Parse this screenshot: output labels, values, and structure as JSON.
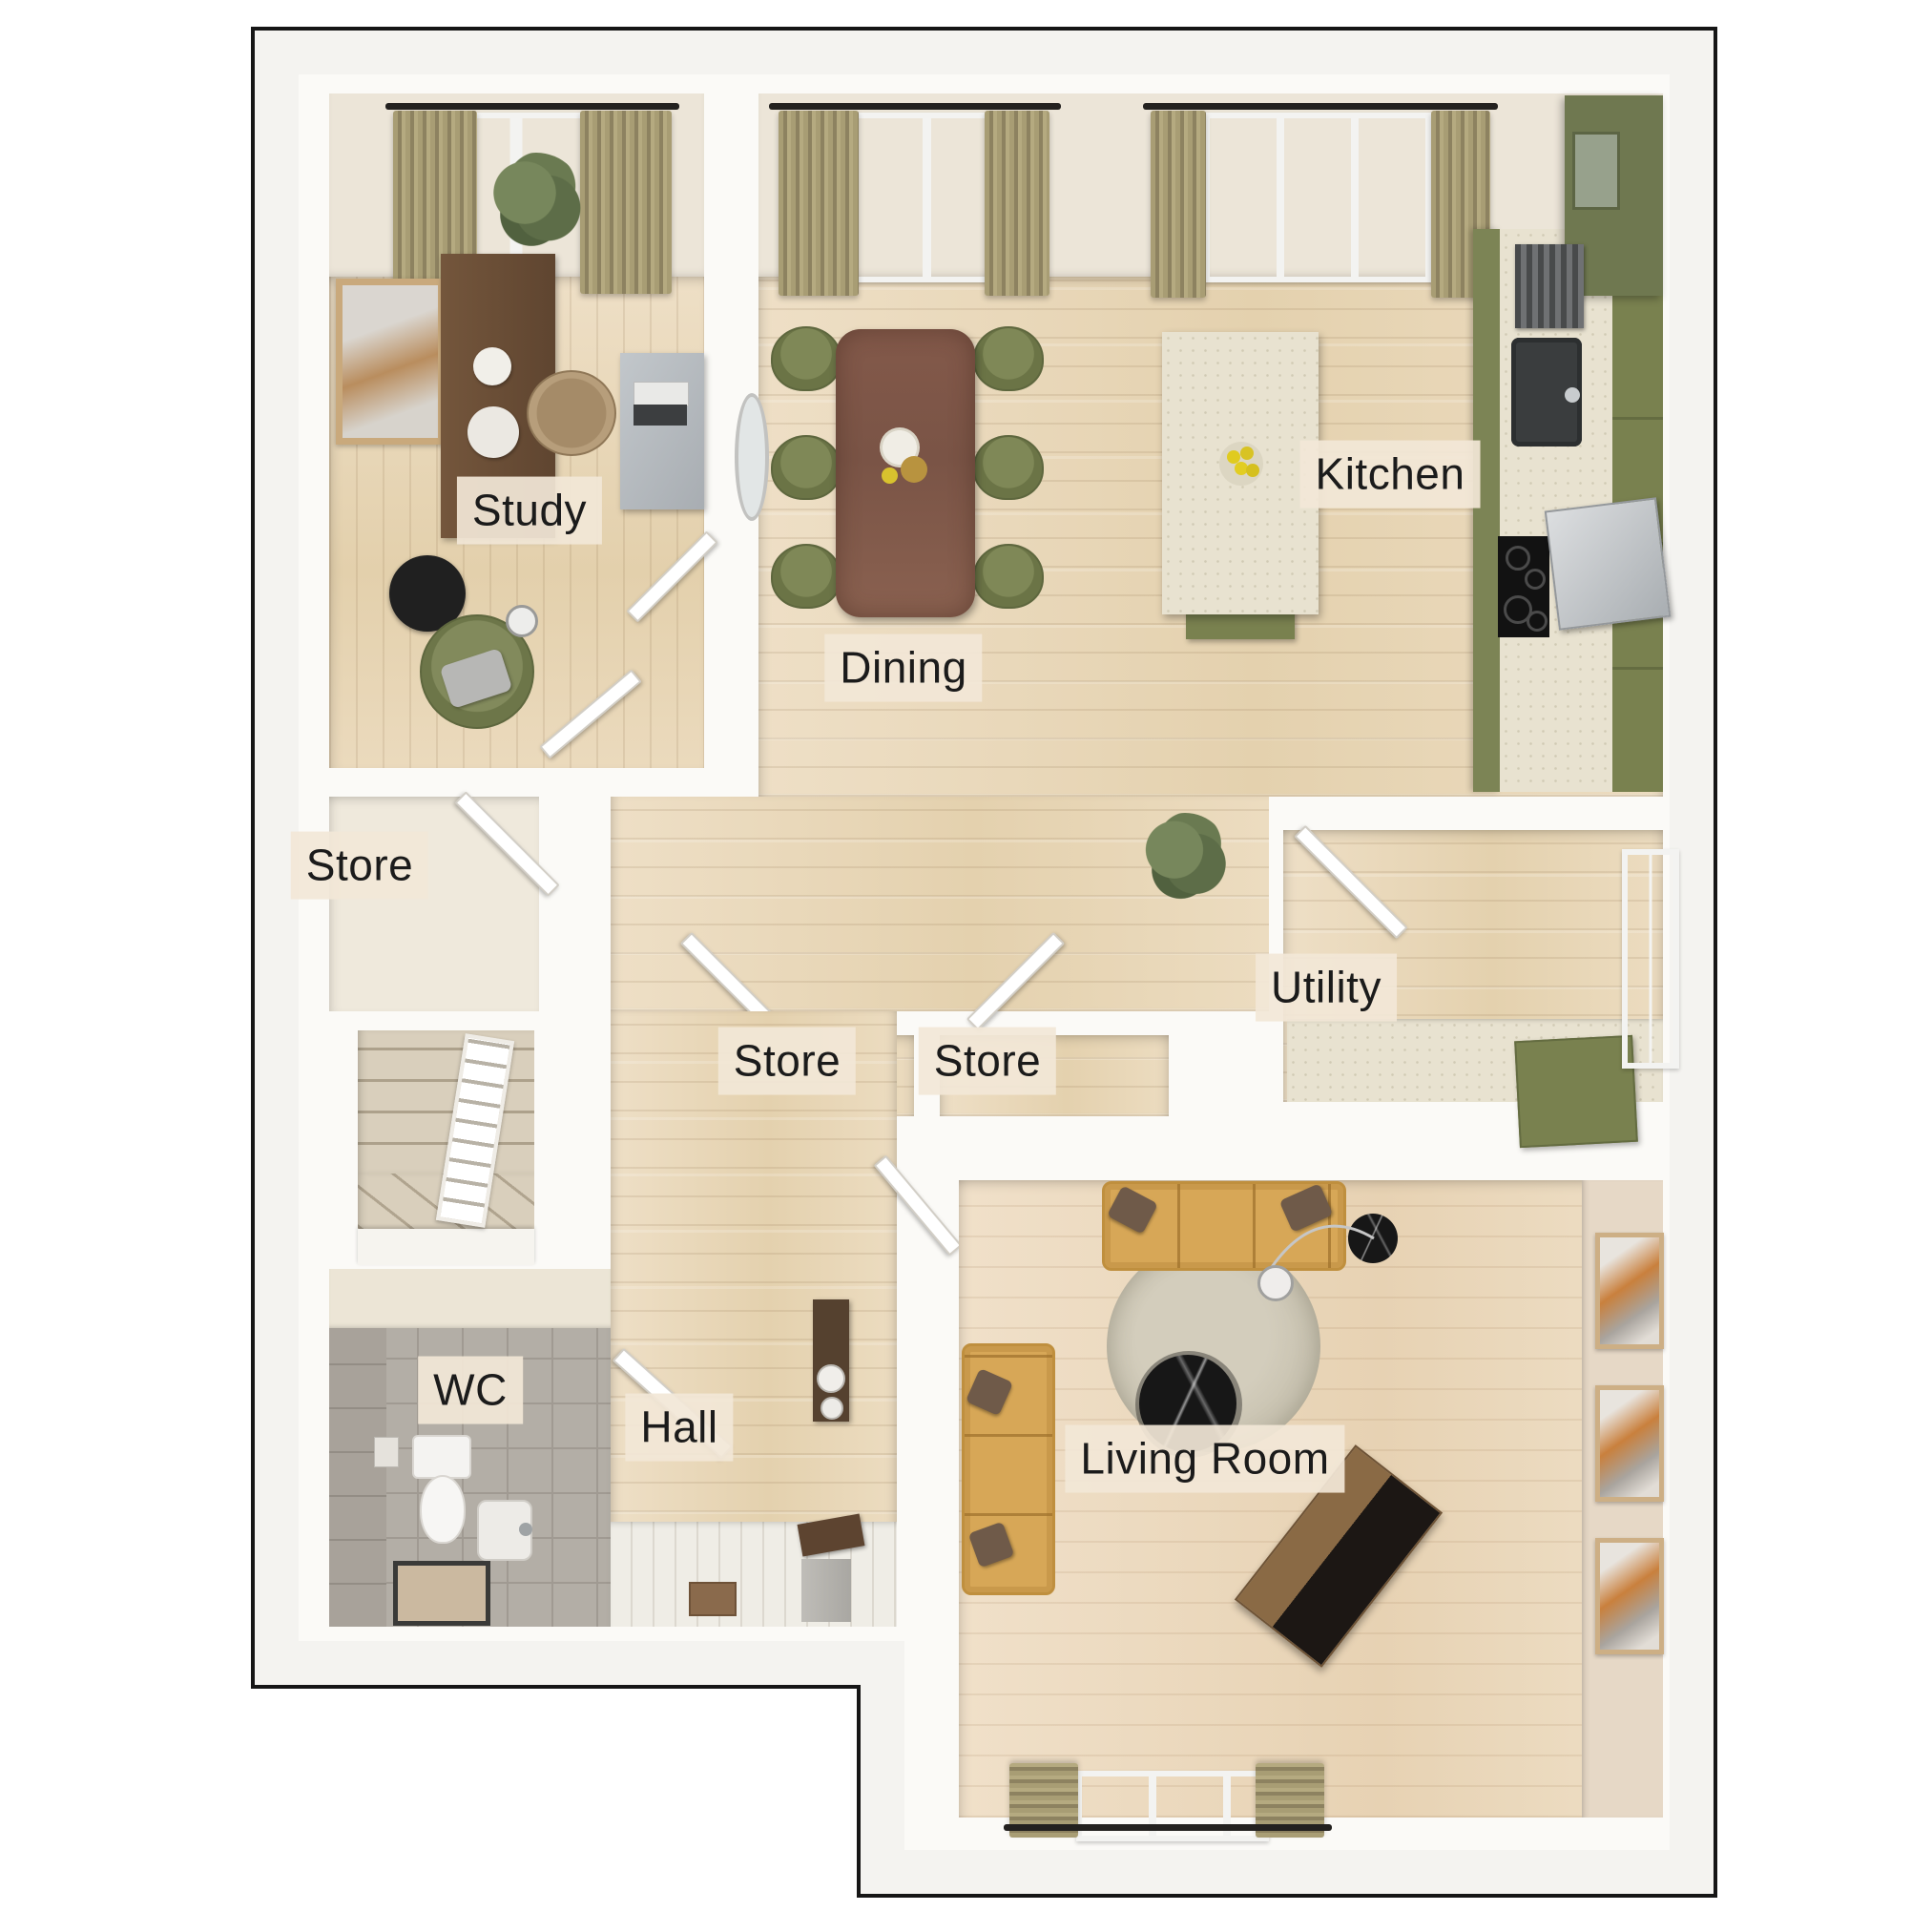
{
  "floorplan": {
    "rooms": [
      {
        "id": "study",
        "label": "Study"
      },
      {
        "id": "dining",
        "label": "Dining"
      },
      {
        "id": "kitchen",
        "label": "Kitchen"
      },
      {
        "id": "store_left",
        "label": "Store"
      },
      {
        "id": "store_mid_left",
        "label": "Store"
      },
      {
        "id": "store_mid_right",
        "label": "Store"
      },
      {
        "id": "utility",
        "label": "Utility"
      },
      {
        "id": "wc",
        "label": "WC"
      },
      {
        "id": "hall",
        "label": "Hall"
      },
      {
        "id": "living_room",
        "label": "Living Room"
      }
    ],
    "colors": {
      "outline": "#161616",
      "wall": "#fbfaf7",
      "margin": "#f4f3f0",
      "wood_floor": "#e9d7ba",
      "label_bg": "#f2e7d7",
      "label_text": "#1b1b1b",
      "olive_green": "#79814f",
      "mustard": "#d7a757",
      "table_wood": "#7f5847",
      "curtain_tan": "#a89d74",
      "tile_grey": "#b3aea6",
      "carpet": "#d9cfbc",
      "marble_black": "#171717"
    }
  }
}
